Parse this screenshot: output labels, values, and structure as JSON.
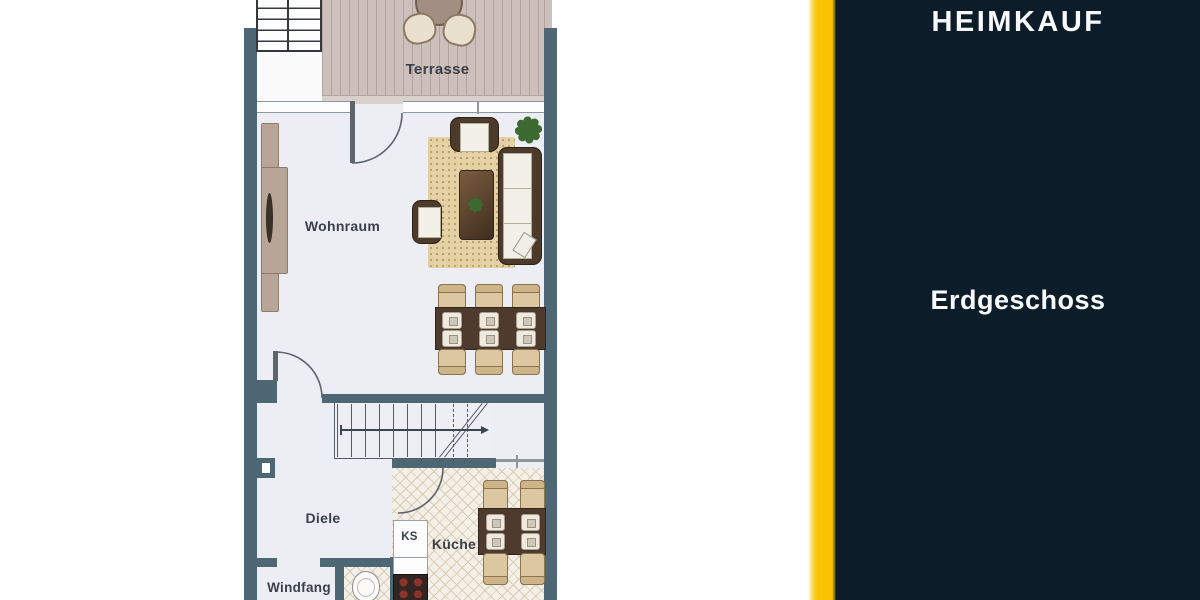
{
  "brand": {
    "name": "HEIMKAUF"
  },
  "panel": {
    "floor_label": "Erdgeschoss"
  },
  "plan": {
    "labels": {
      "terrace": "Terrasse",
      "living_room": "Wohnraum",
      "hallway": "Diele",
      "vestibule": "Windfang",
      "kitchen": "Küche",
      "fridge": "KS"
    },
    "colors": {
      "wall": "#4d6775",
      "accent_yellow": "#f9c301",
      "panel_navy": "#0c1d29",
      "deck": "#cdc0bc",
      "rug": "#e4d2a6",
      "furniture_dark": "#4e3b2e",
      "label_text": "#3a4047"
    }
  }
}
